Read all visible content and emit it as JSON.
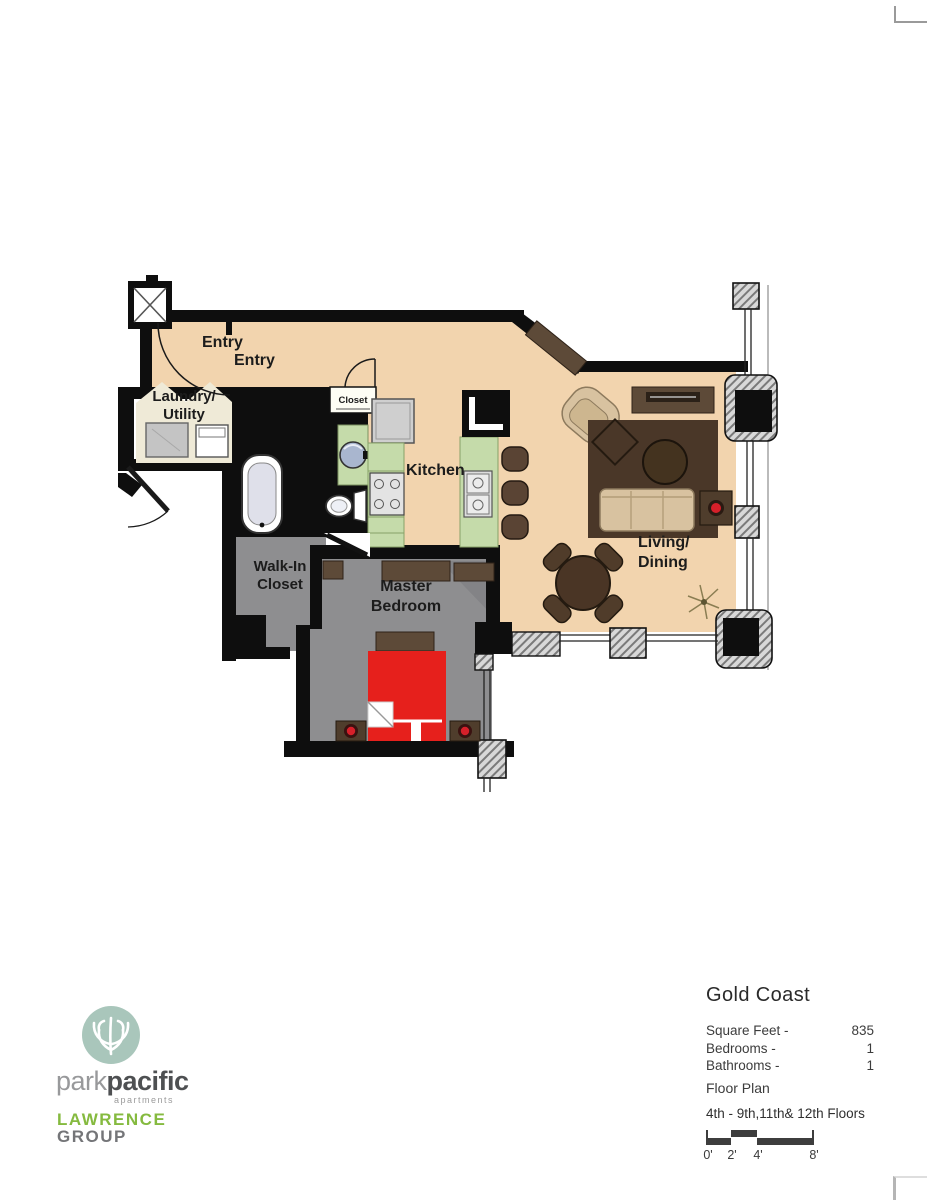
{
  "plan": {
    "labels": {
      "entry_1": "Entry",
      "entry_2": "Entry",
      "laundry_line1": "Laundry/",
      "laundry_line2": "Utility",
      "hall_closet": "Closet",
      "kitchen": "Kitchen",
      "walk_in_line1": "Walk-In",
      "walk_in_line2": "Closet",
      "master_line1": "Master",
      "master_line2": "Bedroom",
      "living_line1": "Living/",
      "living_line2": "Dining"
    },
    "colors": {
      "floor_tan": "#f2d4ae",
      "floor_gray": "#8e8e90",
      "floor_cream": "#efead7",
      "counter_green": "#c5dbaa",
      "wall_black": "#0e0e0e",
      "bed_red": "#e6201c",
      "furniture_brown": "#5d4a38",
      "rug_brown": "#4a3728",
      "lamp_red": "#d6202a"
    }
  },
  "branding": {
    "park": "park",
    "pacific": "pacific",
    "apartments": "apartments",
    "lawrence": "LAWRENCE",
    "group": "GROUP",
    "logo_color": "#a9c6bb",
    "lawrence_green": "#85ba3f"
  },
  "info": {
    "title": "Gold Coast",
    "rows": [
      {
        "label": "Square Feet -",
        "value": "835"
      },
      {
        "label": "Bedrooms -",
        "value": "1"
      },
      {
        "label": "Bathrooms -",
        "value": "1"
      }
    ],
    "floor_plan_label": "Floor Plan",
    "floors_label": "4th - 9th,11th& 12th Floors",
    "scale": {
      "t0": "0'",
      "t2": "2'",
      "t4": "4'",
      "t8": "8'"
    }
  }
}
